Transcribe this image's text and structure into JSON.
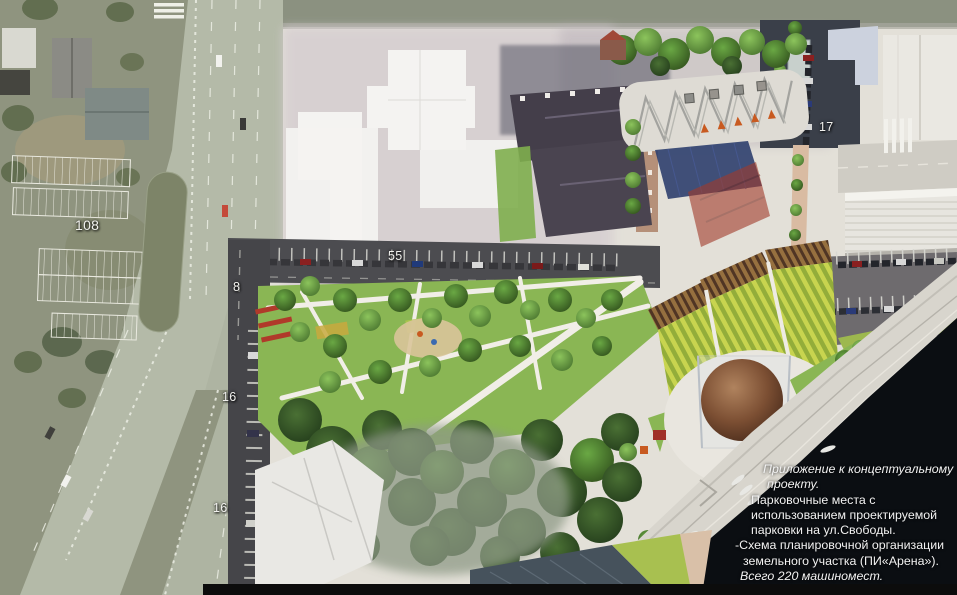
{
  "scene": {
    "kind": "aerial-masterplan-with-satellite-overlay",
    "river_present": true,
    "total_parking_spaces": 220
  },
  "parking_labels": [
    {
      "area": "satellite-parking-lot-freedom-street",
      "count": "108"
    },
    {
      "area": "street-parking-north-row",
      "count": "55"
    },
    {
      "area": "street-parking-west-upper",
      "count": "8"
    },
    {
      "area": "street-parking-west-middle",
      "count": "16"
    },
    {
      "area": "street-parking-west-lower",
      "count": "16"
    },
    {
      "area": "street-parking-east-row",
      "count": "17"
    }
  ],
  "annotation": {
    "lines": [
      {
        "text": "Приложение к концептуальному",
        "style": "italic"
      },
      {
        "text": "проекту.",
        "style": "italic"
      },
      {
        "text": "Парковочные места с",
        "style": "regular"
      },
      {
        "text": "использованием проектируемой",
        "style": "regular"
      },
      {
        "text": "парковки на ул.Свободы.",
        "style": "regular"
      },
      {
        "text": "-Схема планировочной организации",
        "style": "regular"
      },
      {
        "text": "земельного участка (ПИ«Арена»).",
        "style": "regular"
      },
      {
        "text": "Всего 220 машиномест.",
        "style": "italic"
      }
    ],
    "total_spaces": 220
  },
  "colors": {
    "river": "#0b0e12",
    "satellite_ground": "#8f947f",
    "render_plaza": "#e3e0d8",
    "grass": "#8ab654",
    "amphitheater_stripe_light": "#c8d44f",
    "amphitheater_stripe_dark": "#93ad3a",
    "sphere_copper": "#96684a",
    "label_text": "#f1f1ee"
  }
}
